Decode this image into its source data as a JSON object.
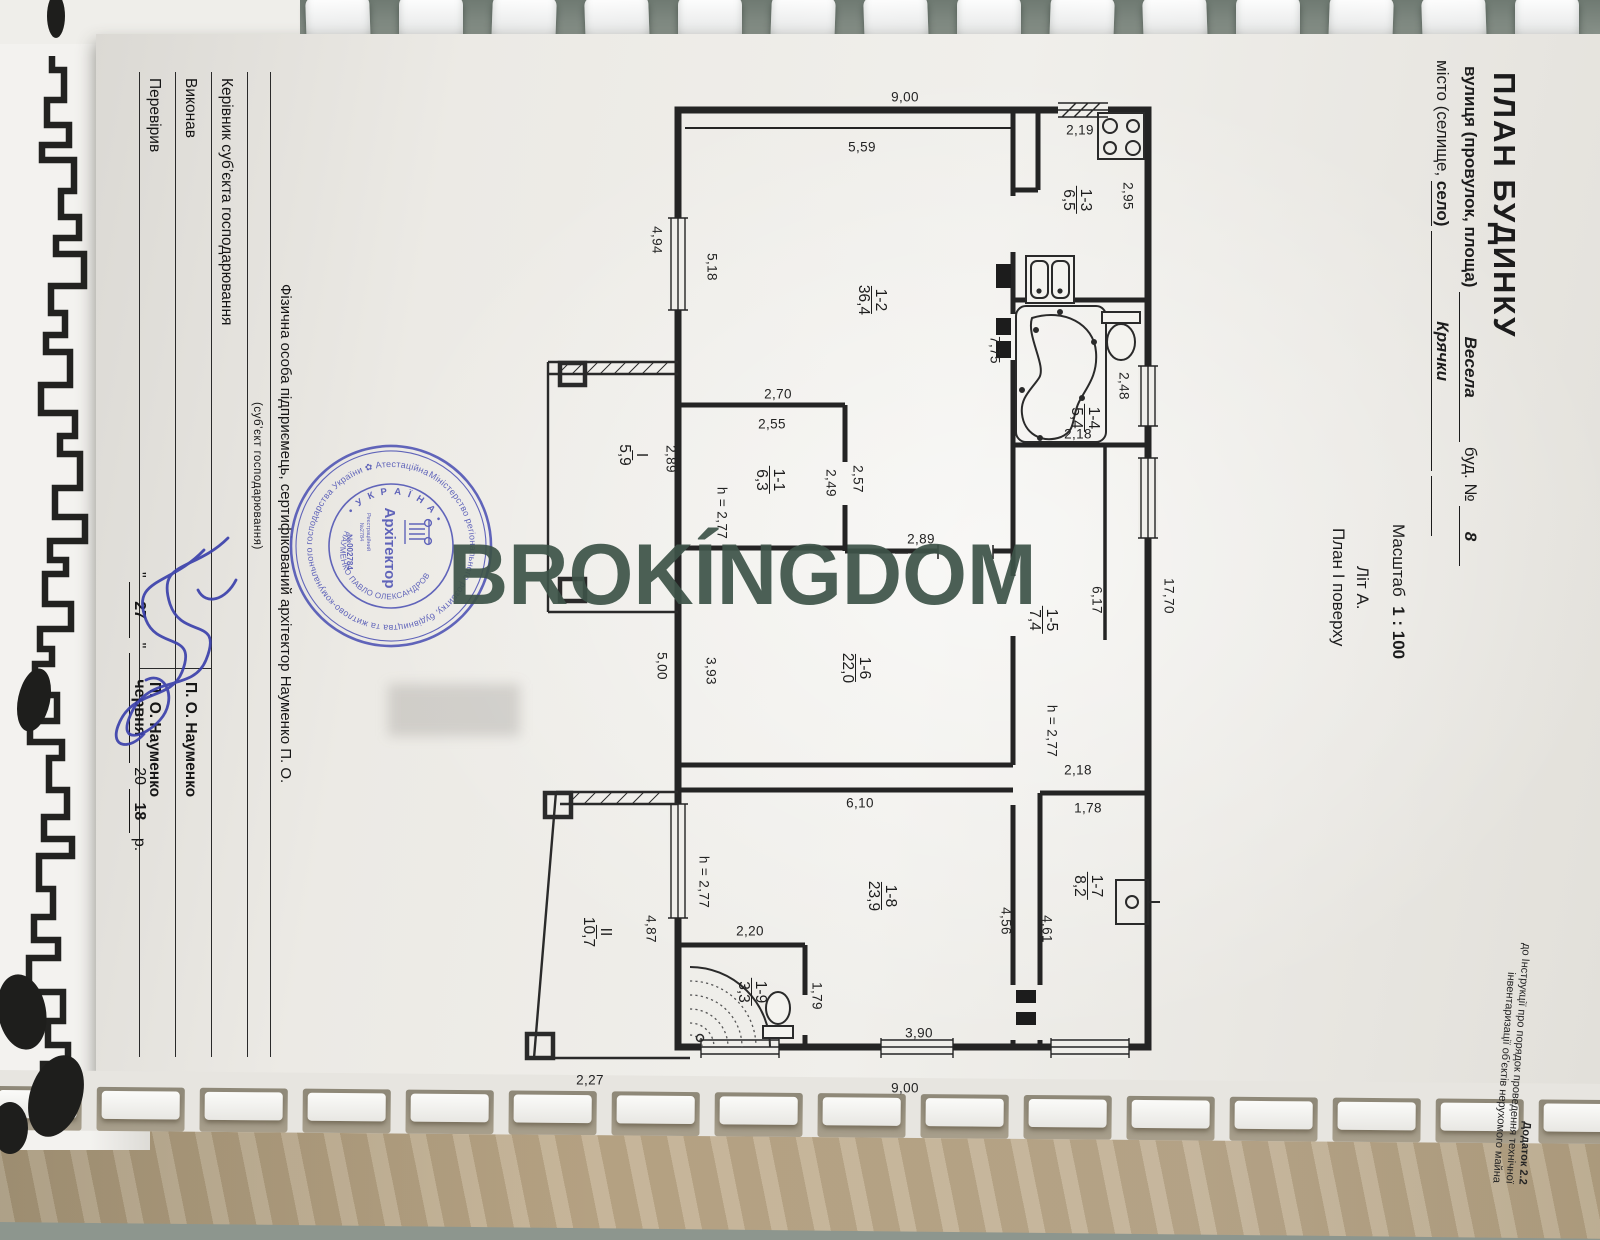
{
  "header": {
    "title": "ПЛАН БУДИНКУ",
    "street_label": "вулиця (провулок, площа)",
    "street_value": "Весела",
    "bud_label": "буд. №",
    "bud_value": "8",
    "city_label": "місто (селище,",
    "city_selo": "село)",
    "city_value": "Крячки",
    "scale_label": "Масштаб",
    "scale_value": "1 : 100",
    "lit": "Літ А.",
    "floor": "План І поверху"
  },
  "footnote": {
    "l1": "Додаток 2.2",
    "l2": "до Інструкції про порядок проведення технічної",
    "l3": "інвентаризації об’єктів нерухомого майна"
  },
  "table": {
    "org": "Фізична особа підприємець, сертифікований архітектор Науменко П. О.",
    "org_sub": "(суб’єкт господарювання)",
    "rows": [
      {
        "label": "Керівник суб’єкта господарювання",
        "name": ""
      },
      {
        "label": "Виконав",
        "name": "П. О. Науменко"
      },
      {
        "label": "Перевірив",
        "name": "П. О. Науменко"
      }
    ],
    "date": {
      "q": "\"",
      "day": "27",
      "month": "червня",
      "century": "20",
      "year": "18",
      "suffix": "р."
    }
  },
  "stamp": {
    "ring": "Міністерство регіонального розвитку, будівництва та житлово-комунального господарства України ✿ Атестаційна архітектурно-будівельна комісія ✿",
    "country": "• У К Р А Ї Н А •",
    "name_arc": "НАУМЕНКО ПАВЛО ОЛЕКСАНДРОВИЧ",
    "profession": "Архітектор",
    "reg1": "Реєстраційний",
    "reg2": "№2784",
    "number": "№002784",
    "color": "#4d52b4"
  },
  "watermark": {
    "text": "BROKÍNGDOM",
    "color": "#3d5348"
  },
  "plan": {
    "rooms": [
      {
        "id": "1-2",
        "area": "36,4",
        "x": 872,
        "y": 300
      },
      {
        "id": "1-3",
        "area": "6,5",
        "x": 1077,
        "y": 200
      },
      {
        "id": "1-4",
        "area": "5,4",
        "x": 1085,
        "y": 418
      },
      {
        "id": "1-5",
        "area": "7,4",
        "x": 1043,
        "y": 620
      },
      {
        "id": "1-1",
        "area": "6,3",
        "x": 770,
        "y": 480
      },
      {
        "id": "1-6",
        "area": "22,0",
        "x": 856,
        "y": 668
      },
      {
        "id": "1-7",
        "area": "8,2",
        "x": 1088,
        "y": 886
      },
      {
        "id": "1-8",
        "area": "23,9",
        "x": 882,
        "y": 896
      },
      {
        "id": "1-9",
        "area": "3,3",
        "x": 752,
        "y": 992
      },
      {
        "id": "I",
        "area": "5,9",
        "x": 633,
        "y": 455
      },
      {
        "id": "II",
        "area": "10,7",
        "x": 597,
        "y": 932
      }
    ],
    "dims": [
      {
        "t": "9,00",
        "x": 905,
        "y": 97,
        "o": "h"
      },
      {
        "t": "5,59",
        "x": 862,
        "y": 147,
        "o": "h"
      },
      {
        "t": "2,19",
        "x": 1080,
        "y": 130,
        "o": "h"
      },
      {
        "t": "2,70",
        "x": 778,
        "y": 394,
        "o": "h"
      },
      {
        "t": "2,55",
        "x": 772,
        "y": 424,
        "o": "h"
      },
      {
        "t": "2,89",
        "x": 921,
        "y": 539,
        "o": "h"
      },
      {
        "t": "2,18",
        "x": 1078,
        "y": 434,
        "o": "h"
      },
      {
        "t": "2,18",
        "x": 1078,
        "y": 770,
        "o": "h"
      },
      {
        "t": "1,78",
        "x": 1088,
        "y": 808,
        "o": "h"
      },
      {
        "t": "6,10",
        "x": 860,
        "y": 803,
        "o": "h"
      },
      {
        "t": "2,20",
        "x": 750,
        "y": 931,
        "o": "h"
      },
      {
        "t": "3,90",
        "x": 919,
        "y": 1033,
        "o": "h"
      },
      {
        "t": "9,00",
        "x": 905,
        "y": 1088,
        "o": "h"
      },
      {
        "t": "2,27",
        "x": 590,
        "y": 1080,
        "o": "h"
      },
      {
        "t": "4,94",
        "x": 657,
        "y": 240,
        "o": "v"
      },
      {
        "t": "5,18",
        "x": 712,
        "y": 267,
        "o": "v"
      },
      {
        "t": "2,95",
        "x": 1128,
        "y": 196,
        "o": "v"
      },
      {
        "t": "7,75",
        "x": 995,
        "y": 350,
        "o": "v"
      },
      {
        "t": "2,48",
        "x": 1124,
        "y": 386,
        "o": "v"
      },
      {
        "t": "2,89",
        "x": 671,
        "y": 459,
        "o": "v"
      },
      {
        "t": "2,49",
        "x": 831,
        "y": 483,
        "o": "v"
      },
      {
        "t": "2,57",
        "x": 858,
        "y": 479,
        "o": "v"
      },
      {
        "t": "h = 2,77",
        "x": 722,
        "y": 513,
        "o": "v"
      },
      {
        "t": "5,00",
        "x": 662,
        "y": 666,
        "o": "v"
      },
      {
        "t": "3,93",
        "x": 711,
        "y": 671,
        "o": "v"
      },
      {
        "t": "6,17",
        "x": 1097,
        "y": 600,
        "o": "v"
      },
      {
        "t": "17,70",
        "x": 1169,
        "y": 596,
        "o": "v"
      },
      {
        "t": "h = 2,77",
        "x": 1052,
        "y": 731,
        "o": "v"
      },
      {
        "t": "h = 2,77",
        "x": 704,
        "y": 882,
        "o": "v"
      },
      {
        "t": "4,87",
        "x": 651,
        "y": 929,
        "o": "v"
      },
      {
        "t": "4,56",
        "x": 1006,
        "y": 921,
        "o": "v"
      },
      {
        "t": "4,61",
        "x": 1047,
        "y": 929,
        "o": "v"
      },
      {
        "t": "1,79",
        "x": 817,
        "y": 996,
        "o": "v"
      }
    ]
  }
}
